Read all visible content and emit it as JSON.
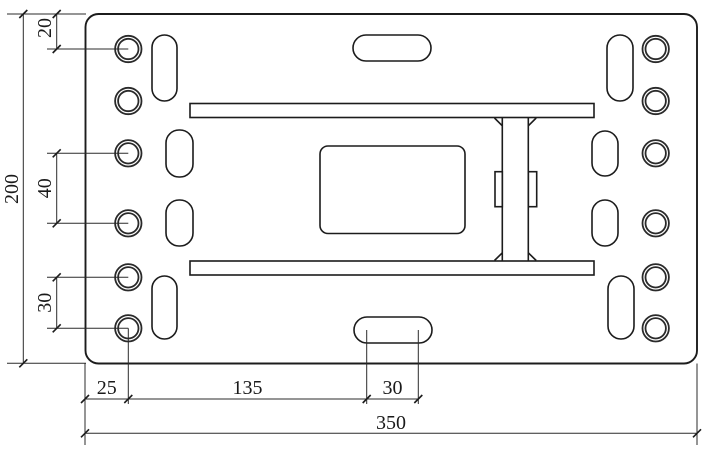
{
  "drawing": {
    "dim_labels": {
      "top_offset": "20",
      "overall_height": "200",
      "hole_spacing_40": "40",
      "hole_spacing_30": "30",
      "edge_to_hole": "25",
      "hole_to_slot": "135",
      "slot_length": "30",
      "overall_width": "350"
    }
  }
}
